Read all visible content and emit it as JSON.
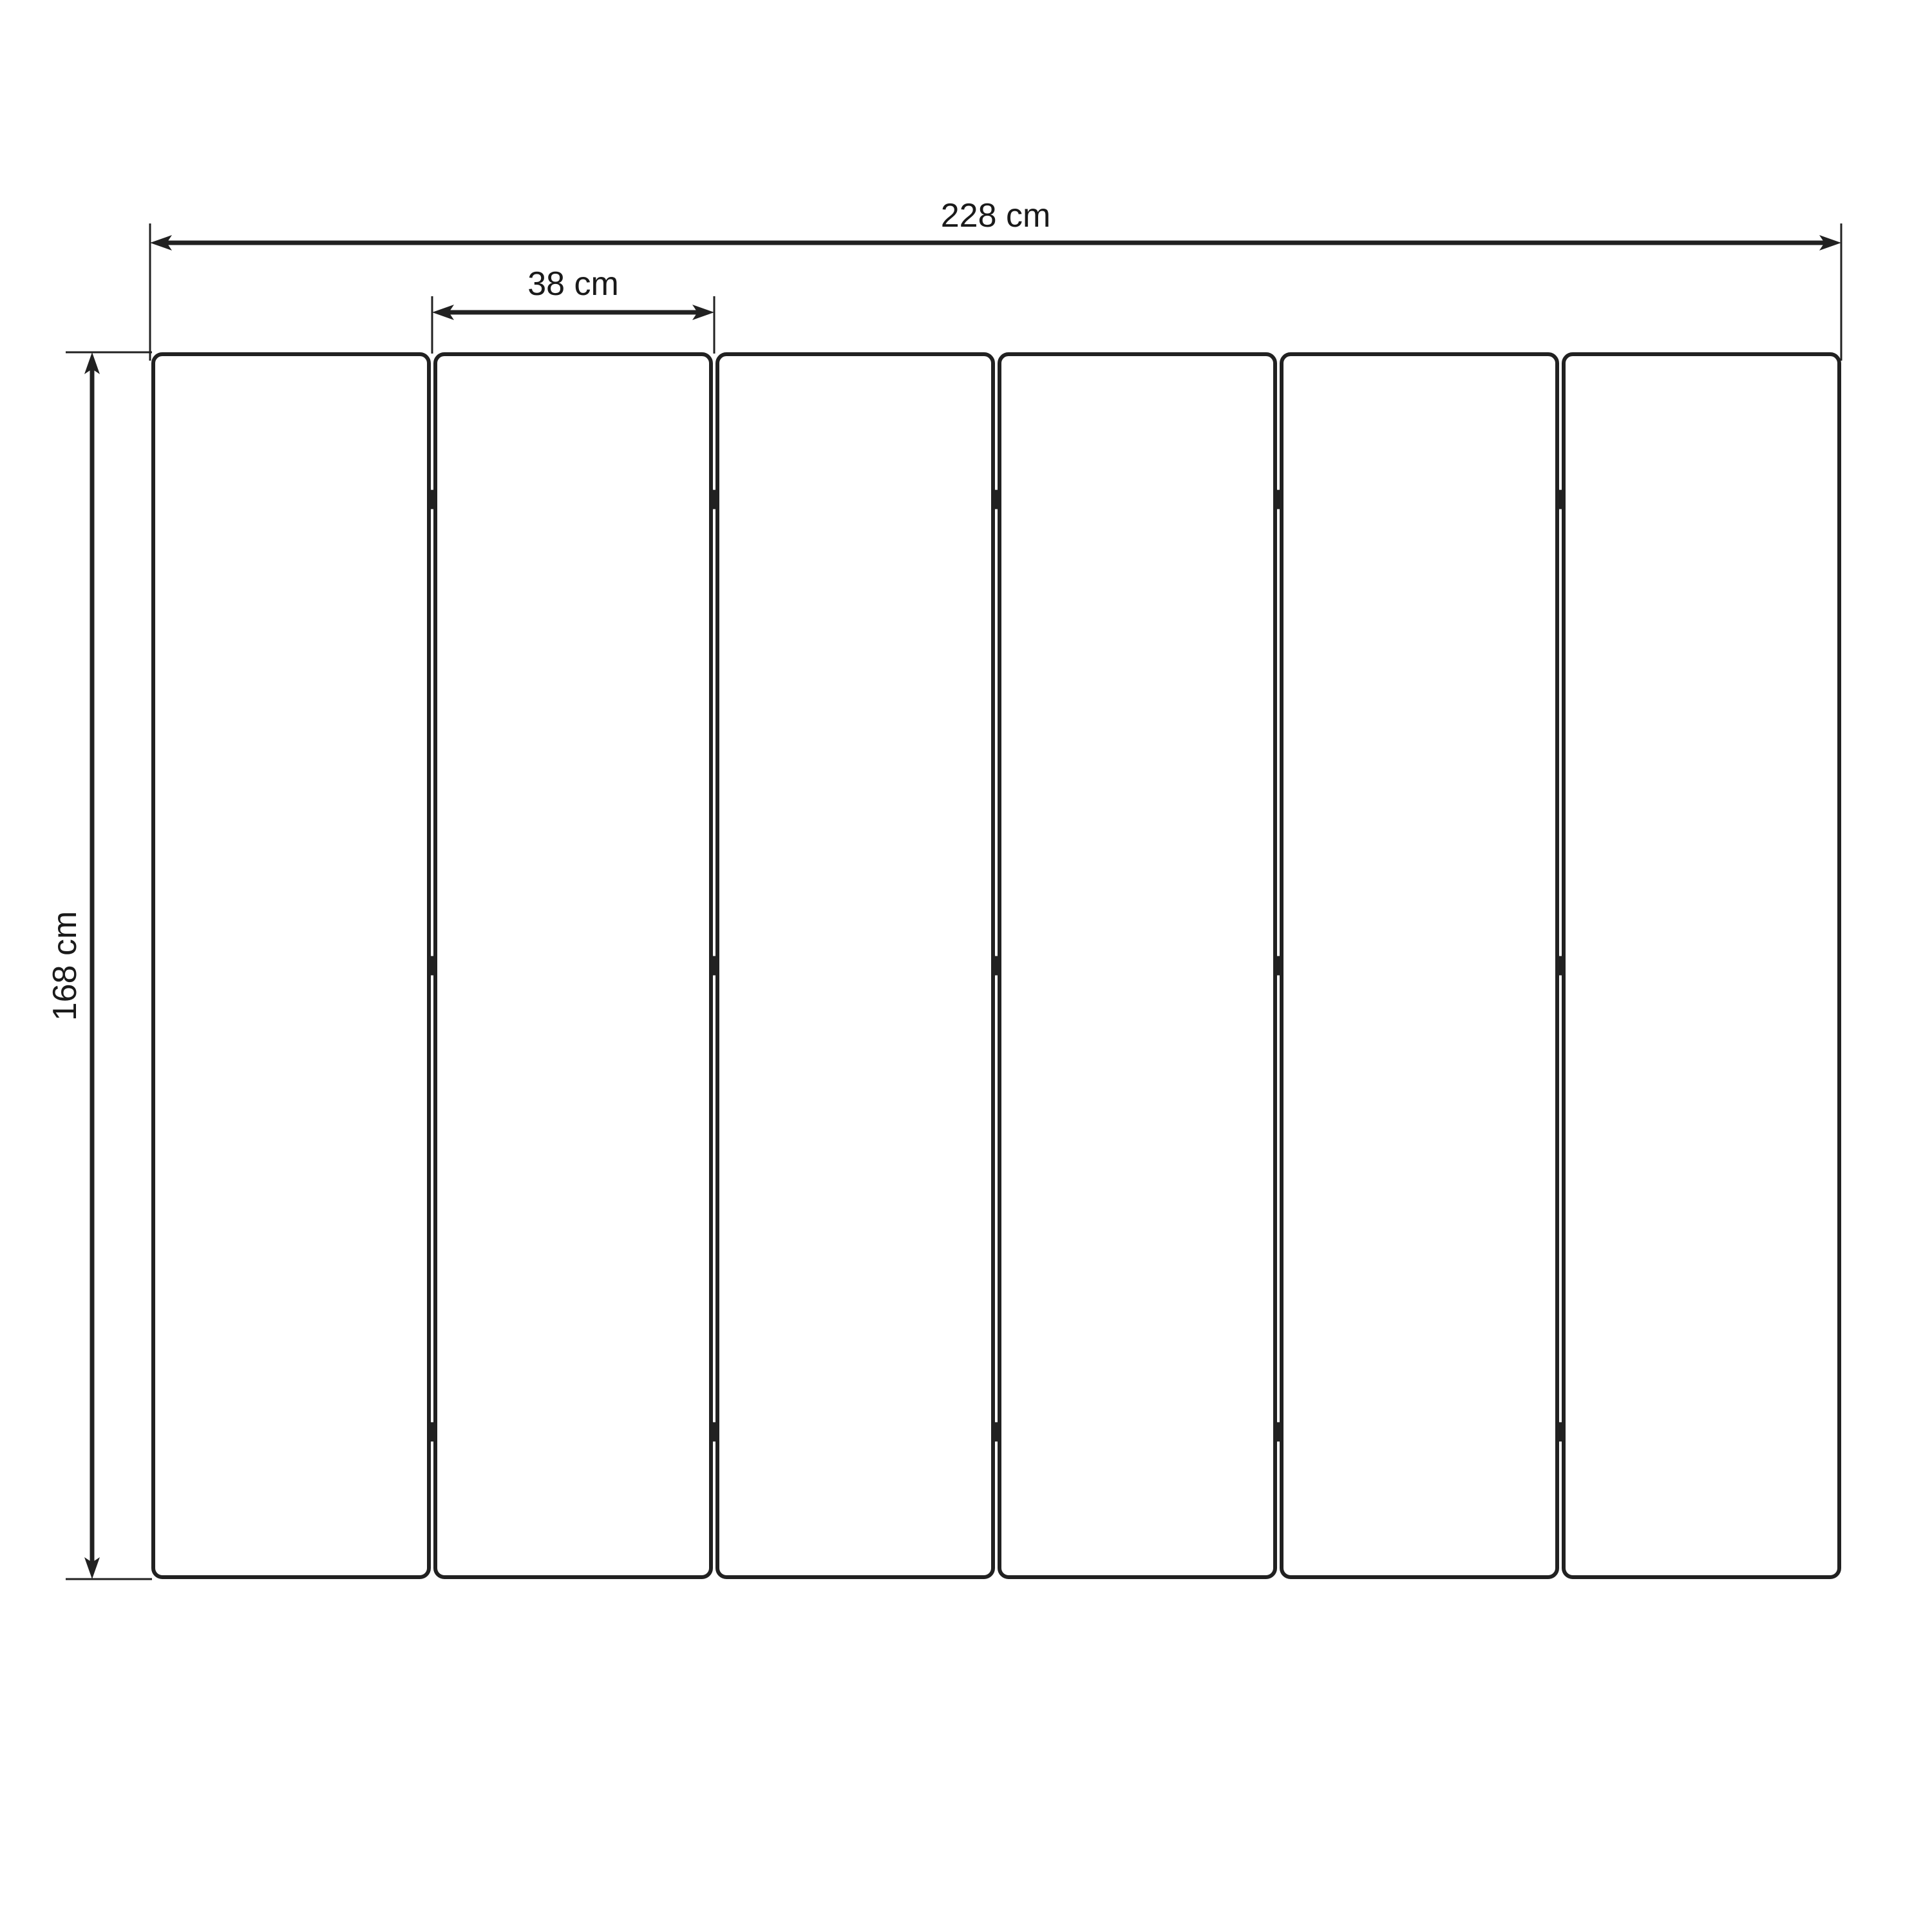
{
  "diagram": {
    "type": "folding-screen-panel-dimension-drawing",
    "panel_count": 6,
    "hinge_rows_per_gap": 3,
    "labels": {
      "total_width": "228 cm",
      "panel_width": "38 cm",
      "height": "168 cm"
    },
    "units": "cm",
    "values": {
      "total_width_cm": 228,
      "panel_width_cm": 38,
      "height_cm": 168
    },
    "colors": {
      "line": "#212121",
      "text": "#1a1a1a",
      "background": "#ffffff"
    }
  }
}
